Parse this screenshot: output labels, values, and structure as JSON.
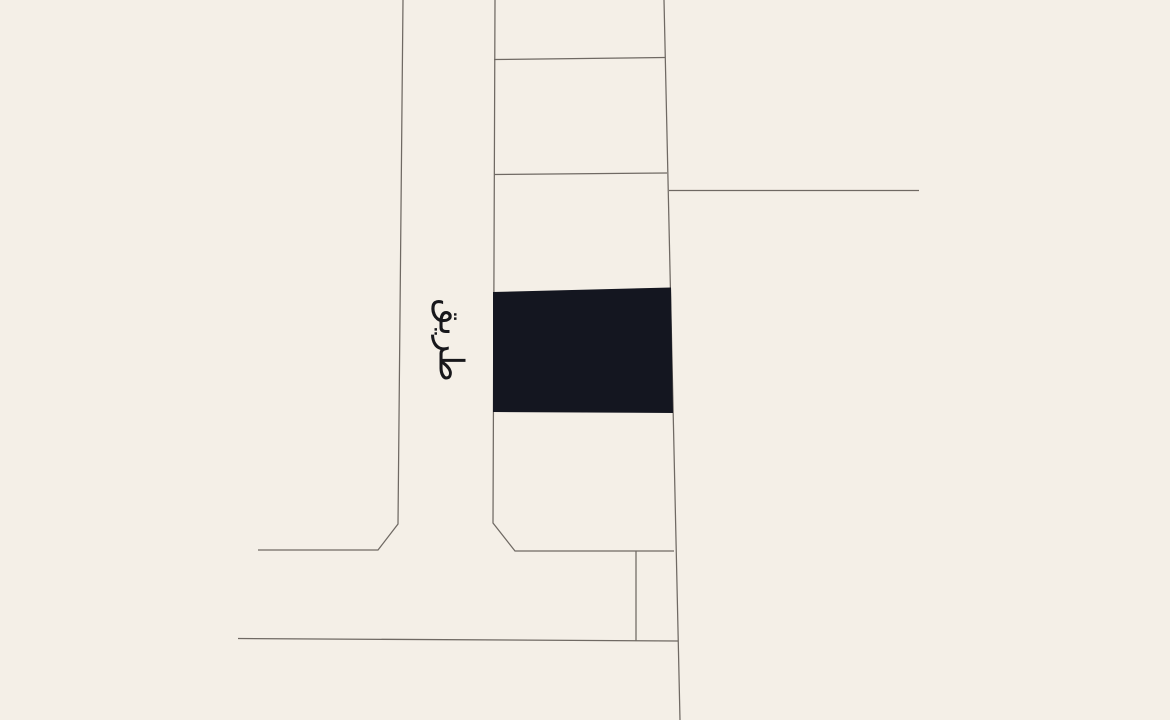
{
  "canvas": {
    "width": 1170,
    "height": 720,
    "background_color": "#f4efe7"
  },
  "map": {
    "line_color": "#6f6963",
    "line_width": 1.25,
    "road_label": {
      "text": "طريق",
      "x": 449,
      "y": 340,
      "rotation_deg": 90,
      "font_size": 34,
      "color": "#17171b"
    },
    "selected_parcel": {
      "fill": "#141620",
      "points": "493,292 671,287.5 673,413 493,412"
    },
    "lines": [
      {
        "name": "road-left-edge",
        "points": "403,0 398,524 378,550 258,550"
      },
      {
        "name": "block-left-edge",
        "points": "495,0 493,523 515,551 674,551"
      },
      {
        "name": "block-right-edge",
        "points": "664,0 680,720"
      },
      {
        "name": "parcel-divider-1",
        "points": "494,59.5 665,57.5"
      },
      {
        "name": "parcel-divider-2",
        "points": "494,174.5 667,173"
      },
      {
        "name": "branch-line-east",
        "points": "669,190.5 919,190.5"
      },
      {
        "name": "inner-parcel-divider",
        "points": "636,551 636,641"
      },
      {
        "name": "road-bottom-edge",
        "points": "238,638.5 678,641"
      }
    ]
  }
}
